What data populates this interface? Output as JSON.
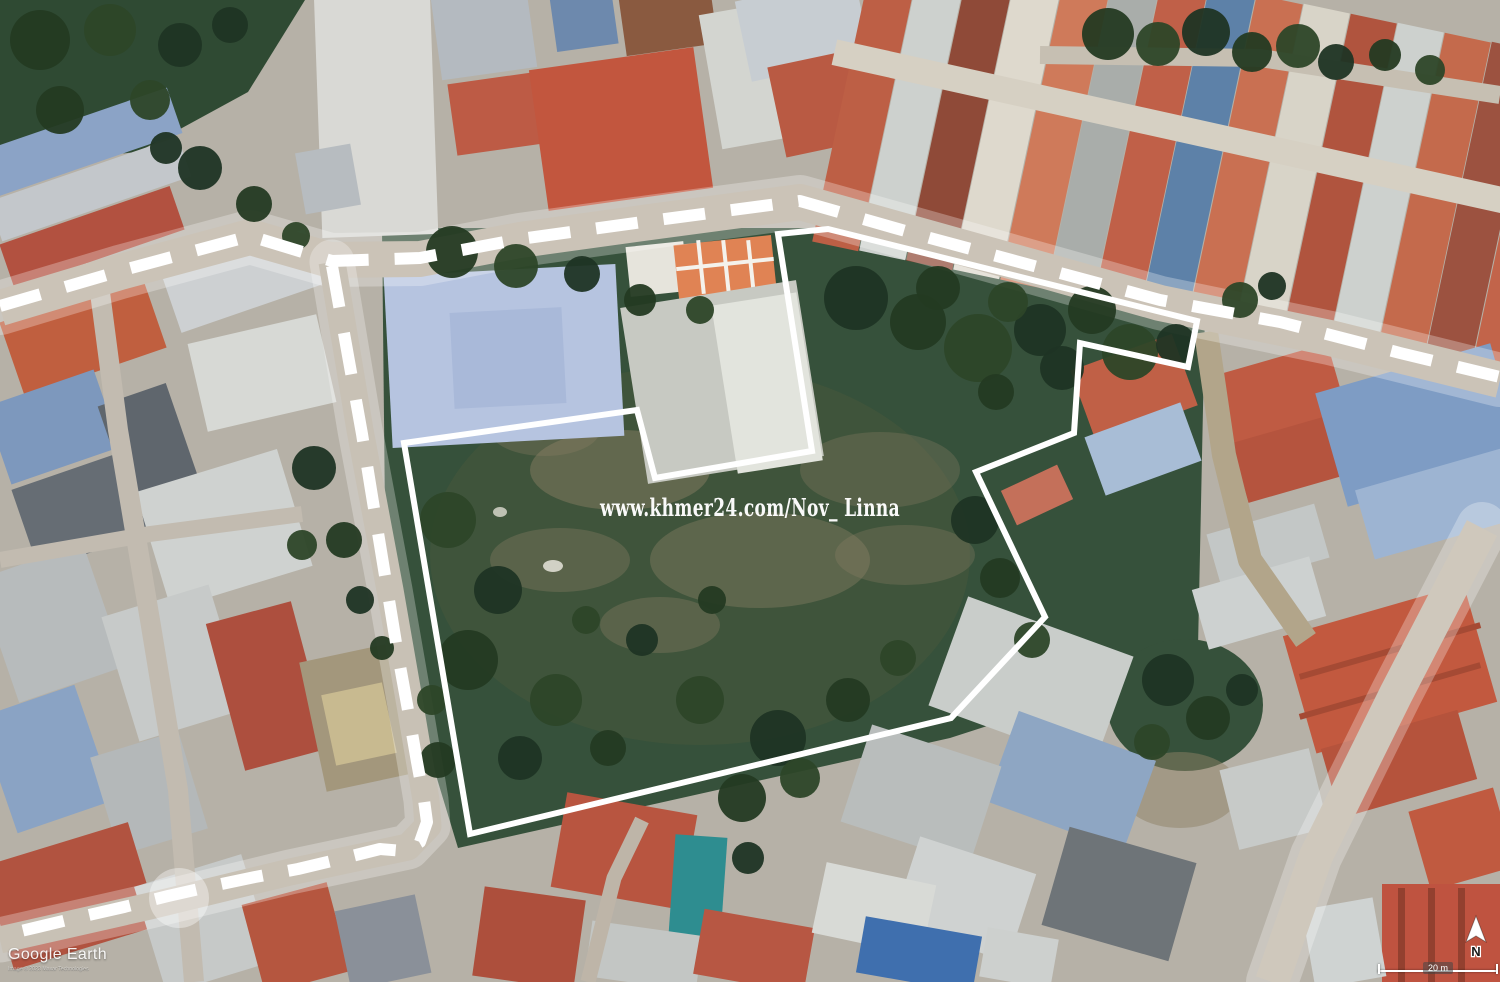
{
  "map": {
    "watermark_text": "www.khmer24.com/Nov_ Linna",
    "annotation_color": "#ffffff",
    "boundary_points": "404,443 637,410 655,478 812,451 778,234 828,229 1197,321 1188,367 1080,343 1074,433 976,472 1045,617 951,718 470,834",
    "route_top_points": "0,306 120,271 250,236 332,261 420,258 520,239 650,221 800,201 930,238 1060,273 1160,300 1280,322 1400,353 1500,377",
    "route_left_points": "332,266 342,322 352,378 362,434 371,490 380,545 389,600 398,655 408,710 417,762 424,800 427,822 420,842 404,851 380,849 340,859 298,869 255,877 212,886 168,896 124,907 80,917 38,927 0,936"
  },
  "footer": {
    "logo_text": "Google Earth",
    "copyright_text": "Image © 2023 Maxar Technologies",
    "scale_label": "20 m",
    "north_label": "N"
  },
  "scene": {
    "bg_color": "#b6b1a7",
    "green_color": "#2f4a33",
    "field_color": "#36513b",
    "topleft_green_points": "0,0 305,0 248,92 138,152 0,165",
    "field_points": "382,228 835,228 1205,312 1198,648 1052,705 950,738 458,848 386,610",
    "right_green": [
      1185,
      705,
      78,
      66
    ],
    "roads": [
      {
        "p": "1206,332 1224,455 1250,560 1306,640",
        "w": 24,
        "c": "#b2a58a",
        "g": false
      },
      {
        "p": "96,262 118,430 150,620 178,790 194,982",
        "w": 20,
        "c": "#c2bbb0",
        "g": false
      },
      {
        "p": "0,560 150,534 302,514",
        "w": 16,
        "c": "#c2bbb0",
        "g": false
      },
      {
        "p": "588,982 614,878 642,820",
        "w": 15,
        "c": "#beb5a8",
        "g": false
      },
      {
        "p": "1040,55 1260,58 1500,95",
        "w": 18,
        "c": "#c6bfb2",
        "g": false
      },
      {
        "p": "0,308 120,272 250,237 330,260 420,259 520,240 650,222 800,202 1000,258 1160,303 1330,338 1500,380",
        "w": 36,
        "c": "#cbc3b7",
        "g": true
      },
      {
        "p": "332,262 360,430 390,590 410,705 426,800 428,826 408,847 290,872 150,906 0,940",
        "w": 27,
        "c": "#c8c1b5",
        "g": true
      },
      {
        "p": "1482,528 1396,694 1316,856 1272,982",
        "w": 34,
        "c": "#cfc8bc",
        "g": true
      }
    ],
    "buildings": [
      [
        -15,
        118,
        195,
        48,
        -19,
        "#8ba3c6"
      ],
      [
        -10,
        168,
        200,
        42,
        -19,
        "#c3c7cb"
      ],
      [
        2,
        214,
        180,
        46,
        -19,
        "#b25140"
      ],
      [
        8,
        296,
        150,
        78,
        -19,
        "#c05f3f"
      ],
      [
        168,
        252,
        150,
        58,
        -19,
        "#cdd0d2"
      ],
      [
        -5,
        386,
        115,
        82,
        -19,
        "#7d98bd"
      ],
      [
        112,
        392,
        72,
        100,
        -19,
        "#5f666d"
      ],
      [
        196,
        328,
        132,
        90,
        -13,
        "#d7d9d5"
      ],
      [
        22,
        468,
        120,
        85,
        -19,
        "#666d74"
      ],
      [
        150,
        468,
        148,
        122,
        -17,
        "#cfd2d0"
      ],
      [
        -5,
        558,
        112,
        130,
        -19,
        "#b7bbbc"
      ],
      [
        118,
        598,
        112,
        130,
        -17,
        "#c7cac9"
      ],
      [
        224,
        610,
        88,
        152,
        -15,
        "#ad4f3e"
      ],
      [
        -5,
        698,
        102,
        122,
        -19,
        "#8aa3c4"
      ],
      [
        103,
        742,
        92,
        102,
        -17,
        "#b4b8b9"
      ],
      [
        312,
        652,
        88,
        132,
        -12,
        "#a3977c"
      ],
      [
        328,
        688,
        62,
        72,
        -12,
        "#c8ba90"
      ],
      [
        -5,
        842,
        152,
        108,
        -17,
        "#b15340"
      ],
      [
        148,
        868,
        112,
        112,
        -17,
        "#c6c9c8"
      ],
      [
        252,
        892,
        88,
        92,
        -15,
        "#b5563f"
      ],
      [
        342,
        902,
        82,
        80,
        -12,
        "#8a9099"
      ],
      [
        318,
        -12,
        116,
        248,
        -2,
        "#d9d9d5"
      ],
      [
        300,
        148,
        56,
        62,
        -10,
        "#b7bcc0"
      ],
      [
        436,
        -8,
        96,
        82,
        -8,
        "#b4bac0"
      ],
      [
        452,
        78,
        86,
        72,
        -8,
        "#bd5b45"
      ],
      [
        538,
        58,
        166,
        142,
        -8,
        "#c2563e"
      ],
      [
        553,
        -8,
        62,
        56,
        -8,
        "#6d89ad"
      ],
      [
        622,
        -12,
        92,
        62,
        -8,
        "#8a5a40"
      ],
      [
        710,
        8,
        72,
        136,
        -10,
        "#d3d5d0"
      ],
      [
        742,
        -12,
        122,
        82,
        -12,
        "#c7cdd2"
      ],
      [
        776,
        58,
        82,
        92,
        -12,
        "#b95a43"
      ],
      [
        846,
        -80,
        47,
        330,
        12,
        "#bd5f45"
      ],
      [
        893,
        -71,
        47,
        330,
        12,
        "#cdd1ce"
      ],
      [
        940,
        -61,
        47,
        330,
        12,
        "#8f4a38"
      ],
      [
        987,
        -52,
        47,
        330,
        12,
        "#ded9cd"
      ],
      [
        1034,
        -42,
        47,
        330,
        12,
        "#cf7a5a"
      ],
      [
        1081,
        -33,
        47,
        330,
        12,
        "#a9adaa"
      ],
      [
        1128,
        -23,
        47,
        330,
        12,
        "#c06048"
      ],
      [
        1175,
        -14,
        47,
        330,
        12,
        "#5d81a8"
      ],
      [
        1222,
        -4,
        47,
        330,
        12,
        "#c97052"
      ],
      [
        1269,
        5,
        47,
        330,
        12,
        "#d8d4c8"
      ],
      [
        1316,
        15,
        47,
        330,
        12,
        "#b0543e"
      ],
      [
        1363,
        24,
        47,
        330,
        12,
        "#cdd1ce"
      ],
      [
        1410,
        34,
        47,
        330,
        12,
        "#c46a4c"
      ],
      [
        1457,
        43,
        47,
        330,
        12,
        "#9c5240"
      ],
      [
        1504,
        53,
        47,
        330,
        12,
        "#c2644a"
      ],
      [
        826,
        116,
        710,
        26,
        12.5,
        "#d6d0c3"
      ],
      [
        628,
        244,
        58,
        50,
        -6,
        "#e6e4dc"
      ],
      [
        676,
        240,
        98,
        54,
        -6,
        "#e08354"
      ],
      [
        676,
        262,
        98,
        4,
        -6,
        "#f4f2ec"
      ],
      [
        699,
        240,
        4,
        54,
        -6,
        "#f4f2ec"
      ],
      [
        724,
        240,
        4,
        54,
        -6,
        "#f4f2ec"
      ],
      [
        749,
        240,
        4,
        54,
        -6,
        "#f4f2ec"
      ],
      [
        388,
        270,
        232,
        172,
        -3,
        "#b6c4e0"
      ],
      [
        452,
        310,
        112,
        96,
        -3,
        "#a9b9d9"
      ],
      [
        633,
        293,
        178,
        178,
        -9,
        "#c7c9c2"
      ],
      [
        724,
        298,
        86,
        170,
        -9,
        "#e2e4dd"
      ],
      [
        1080,
        350,
        108,
        76,
        -20,
        "#c06046"
      ],
      [
        1092,
        418,
        102,
        62,
        -20,
        "#a8bdd6"
      ],
      [
        1006,
        476,
        62,
        38,
        -25,
        "#c4705a"
      ],
      [
        1222,
        358,
        118,
        76,
        -16,
        "#bf5b43"
      ],
      [
        1238,
        428,
        102,
        62,
        -16,
        "#b5543e"
      ],
      [
        1328,
        366,
        182,
        118,
        -16,
        "#7e9cc4"
      ],
      [
        1362,
        468,
        152,
        72,
        -16,
        "#9db4d2"
      ],
      [
        1212,
        518,
        112,
        56,
        -16,
        "#c3c7c6"
      ],
      [
        1198,
        572,
        122,
        62,
        -16,
        "#cdd1d0"
      ],
      [
        1296,
        608,
        188,
        122,
        -16,
        "#c2593f"
      ],
      [
        1296,
        648,
        188,
        6,
        -16,
        "#a54a34"
      ],
      [
        1296,
        688,
        188,
        6,
        -16,
        "#a54a34"
      ],
      [
        1328,
        728,
        142,
        72,
        -16,
        "#b5533c"
      ],
      [
        1418,
        798,
        88,
        82,
        -16,
        "#c05a40"
      ],
      [
        1228,
        758,
        92,
        82,
        -14,
        "#c7cac8"
      ],
      [
        1382,
        884,
        122,
        100,
        0,
        "#bf5340"
      ],
      [
        1398,
        888,
        7,
        94,
        0,
        "#93402f"
      ],
      [
        1428,
        888,
        7,
        94,
        0,
        "#93402f"
      ],
      [
        1458,
        888,
        7,
        94,
        0,
        "#93402f"
      ],
      [
        1308,
        903,
        72,
        80,
        -10,
        "#cfd3d2"
      ],
      [
        943,
        623,
        176,
        116,
        20,
        "#c9cdca"
      ],
      [
        998,
        733,
        146,
        96,
        20,
        "#8ea6c3"
      ],
      [
        853,
        743,
        136,
        102,
        18,
        "#b9bdbc"
      ],
      [
        903,
        853,
        122,
        92,
        18,
        "#cfd2d1"
      ],
      [
        1053,
        843,
        132,
        102,
        16,
        "#6e7478"
      ],
      [
        558,
        803,
        132,
        96,
        10,
        "#b85540"
      ],
      [
        672,
        836,
        52,
        100,
        4,
        "#2e8d90"
      ],
      [
        478,
        893,
        102,
        90,
        8,
        "#ad4f3c"
      ],
      [
        588,
        928,
        112,
        56,
        8,
        "#c3c6c4"
      ],
      [
        698,
        918,
        112,
        66,
        10,
        "#b75743"
      ],
      [
        818,
        873,
        112,
        72,
        12,
        "#d8dad6"
      ],
      [
        860,
        926,
        118,
        57,
        10,
        "#3f6fae"
      ],
      [
        983,
        933,
        72,
        50,
        10,
        "#cdd0ce"
      ]
    ],
    "dirt": [
      [
        700,
        555,
        270,
        190,
        0.5,
        "#47573c"
      ],
      [
        620,
        470,
        90,
        40,
        0.45,
        "#8d8166"
      ],
      [
        760,
        560,
        110,
        48,
        0.4,
        "#8d8166"
      ],
      [
        560,
        560,
        70,
        32,
        0.35,
        "#8d8166"
      ],
      [
        880,
        470,
        80,
        38,
        0.3,
        "#8d8166"
      ],
      [
        660,
        625,
        60,
        28,
        0.35,
        "#8d8166"
      ],
      [
        545,
        430,
        55,
        26,
        0.3,
        "#8d8166"
      ],
      [
        905,
        555,
        70,
        30,
        0.3,
        "#8d8166"
      ],
      [
        1180,
        790,
        60,
        38,
        0.5,
        "#8d8166"
      ],
      [
        553,
        566,
        10,
        6,
        0.85,
        "#e6e4da"
      ],
      [
        500,
        512,
        7,
        5,
        0.8,
        "#dedcd2"
      ]
    ],
    "trees": [
      [
        1108,
        34,
        26
      ],
      [
        1158,
        44,
        22
      ],
      [
        1206,
        32,
        24
      ],
      [
        1252,
        52,
        20
      ],
      [
        1298,
        46,
        22
      ],
      [
        1336,
        62,
        18
      ],
      [
        1385,
        55,
        16
      ],
      [
        1430,
        70,
        15
      ],
      [
        200,
        168,
        22
      ],
      [
        254,
        204,
        18
      ],
      [
        296,
        236,
        14
      ],
      [
        166,
        148,
        16
      ],
      [
        452,
        252,
        26
      ],
      [
        516,
        266,
        22
      ],
      [
        582,
        274,
        18
      ],
      [
        640,
        300,
        16
      ],
      [
        700,
        310,
        14
      ],
      [
        856,
        298,
        32
      ],
      [
        918,
        322,
        28
      ],
      [
        978,
        348,
        34
      ],
      [
        1040,
        330,
        26
      ],
      [
        1092,
        310,
        24
      ],
      [
        1130,
        352,
        28
      ],
      [
        1176,
        344,
        20
      ],
      [
        938,
        288,
        22
      ],
      [
        1008,
        302,
        20
      ],
      [
        1062,
        368,
        22
      ],
      [
        996,
        392,
        18
      ],
      [
        448,
        520,
        28
      ],
      [
        498,
        590,
        24
      ],
      [
        468,
        660,
        30
      ],
      [
        556,
        700,
        26
      ],
      [
        520,
        758,
        22
      ],
      [
        608,
        748,
        18
      ],
      [
        700,
        700,
        24
      ],
      [
        778,
        738,
        28
      ],
      [
        848,
        700,
        22
      ],
      [
        898,
        658,
        18
      ],
      [
        642,
        640,
        16
      ],
      [
        712,
        600,
        14
      ],
      [
        586,
        620,
        14
      ],
      [
        975,
        520,
        24
      ],
      [
        1000,
        578,
        20
      ],
      [
        1032,
        640,
        18
      ],
      [
        1168,
        680,
        26
      ],
      [
        1208,
        718,
        22
      ],
      [
        1152,
        742,
        18
      ],
      [
        1242,
        690,
        16
      ],
      [
        742,
        798,
        24
      ],
      [
        800,
        778,
        20
      ],
      [
        748,
        858,
        16
      ],
      [
        438,
        760,
        18
      ],
      [
        432,
        700,
        15
      ],
      [
        314,
        468,
        22
      ],
      [
        344,
        540,
        18
      ],
      [
        302,
        545,
        15
      ],
      [
        360,
        600,
        14
      ],
      [
        382,
        648,
        12
      ],
      [
        1240,
        300,
        18
      ],
      [
        1272,
        286,
        14
      ],
      [
        40,
        40,
        30
      ],
      [
        110,
        30,
        26
      ],
      [
        180,
        45,
        22
      ],
      [
        60,
        110,
        24
      ],
      [
        150,
        100,
        20
      ],
      [
        230,
        25,
        18
      ]
    ],
    "tree_colors": [
      "#243a22",
      "#2d4628",
      "#1f3424"
    ]
  }
}
